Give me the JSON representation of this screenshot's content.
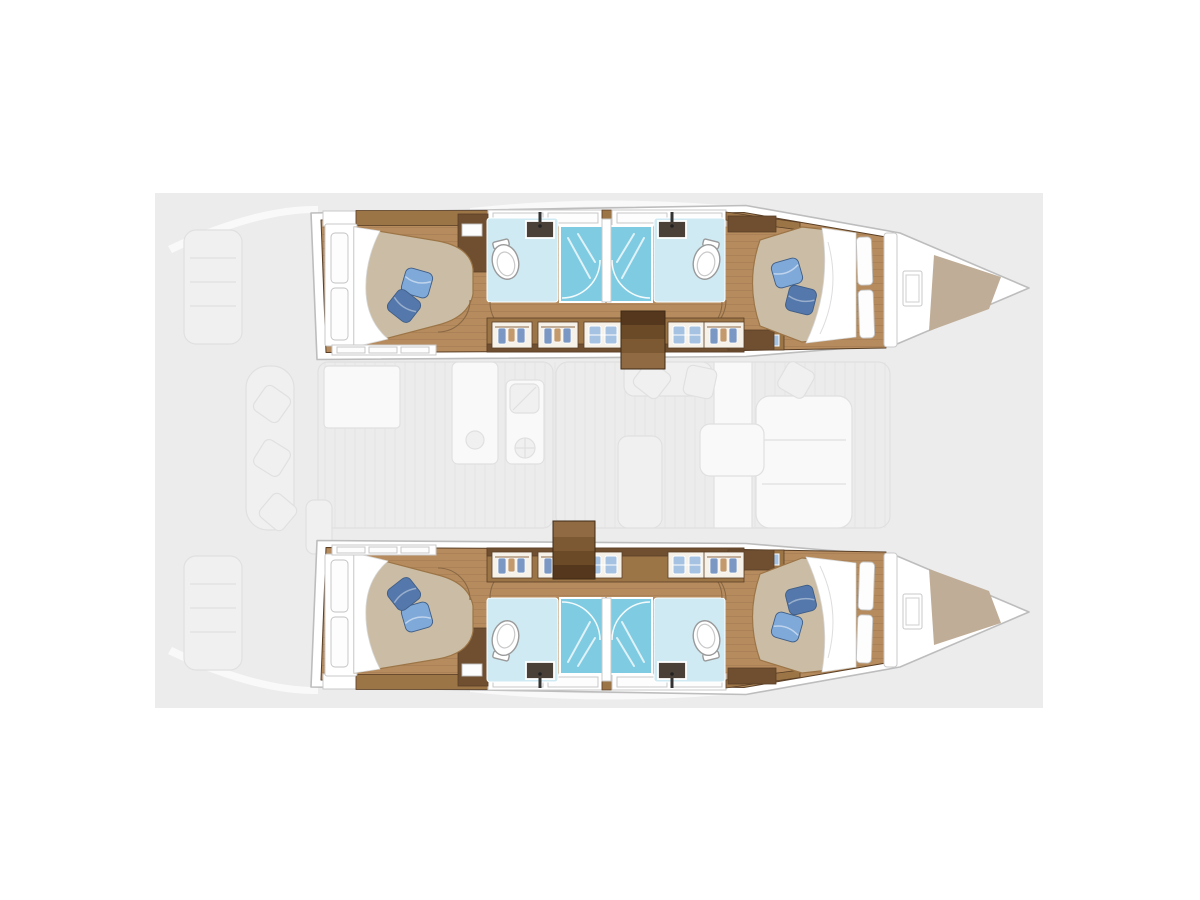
{
  "image": {
    "label": "Catamaran interior layout floor plan, bows pointing right: two detailed hulls each with aft double cabin, two bathrooms with central shower stalls, wardrobe lockers, companionway stairs, forward double cabin and forepeak storage; faded main-deck cockpit, galley and saloon shown between the hulls"
  },
  "colors": {
    "canvas": "#ececec",
    "hull_white": "#ffffff",
    "hull_stroke": "#bdbdbd",
    "wood_floor": "#b68c5e",
    "wood_mid": "#9c7547",
    "wood_dark": "#6f4f30",
    "wood_edge": "#5a3f26",
    "mattress": "#cbbda5",
    "pillow_light": "#7fa9d9",
    "pillow_dark": "#5478ab",
    "pillow_edge": "#3f5d86",
    "bath_floor": "#cfeaf3",
    "shower_blue": "#7fcbe1",
    "sink_dark": "#4a4038",
    "door_arc": "#8a6845",
    "forepeak_tan": "#c0ad97",
    "locker_panel": "#f6f1e9",
    "hanger_blue": "#7b98c4",
    "hanger_tan": "#c49a6c",
    "linen_blue": "#a5c2e2",
    "ghost_panel": "#f1f1f1",
    "ghost_white": "#fafafa",
    "ghost_stroke": "#e0e0e0",
    "stair_1": "#54371c",
    "stair_2": "#6b4a28",
    "stair_3": "#7d5933",
    "stair_4": "#8f6a42"
  },
  "floorplan": {
    "vessel": "catamaran",
    "orientation": "bow-right",
    "hulls": [
      {
        "id": "port-hull",
        "position": "top",
        "rooms": [
          "aft-double-cabin",
          "bathroom",
          "shower",
          "shower",
          "bathroom",
          "forward-double-cabin",
          "forepeak-storage"
        ]
      },
      {
        "id": "starboard-hull",
        "position": "bottom",
        "rooms": [
          "aft-double-cabin",
          "bathroom",
          "shower",
          "shower",
          "bathroom",
          "forward-double-cabin",
          "forepeak-storage"
        ]
      }
    ],
    "main_deck_faded": [
      "stern-platforms",
      "davits",
      "cockpit-table",
      "cockpit-bench",
      "galley-sink",
      "galley-stove",
      "walkway",
      "saloon-sofa",
      "saloon-table",
      "chairs"
    ]
  },
  "icons": {
    "toilet-icon": "white oval bowl",
    "sink-icon": "dark basin with faucet",
    "shower-icon": "blue stall with glass-door arc and water jets",
    "bed-icon": "taupe mattress with white sheet and two blue pillows",
    "wardrobe-hanger-icon": "garments hanging on rail",
    "linen-shelf-icon": "folded linen stacks",
    "stairs-icon": "wooden treads",
    "window-icon": "framed pane",
    "door-swing-icon": "quarter-circle arc"
  }
}
